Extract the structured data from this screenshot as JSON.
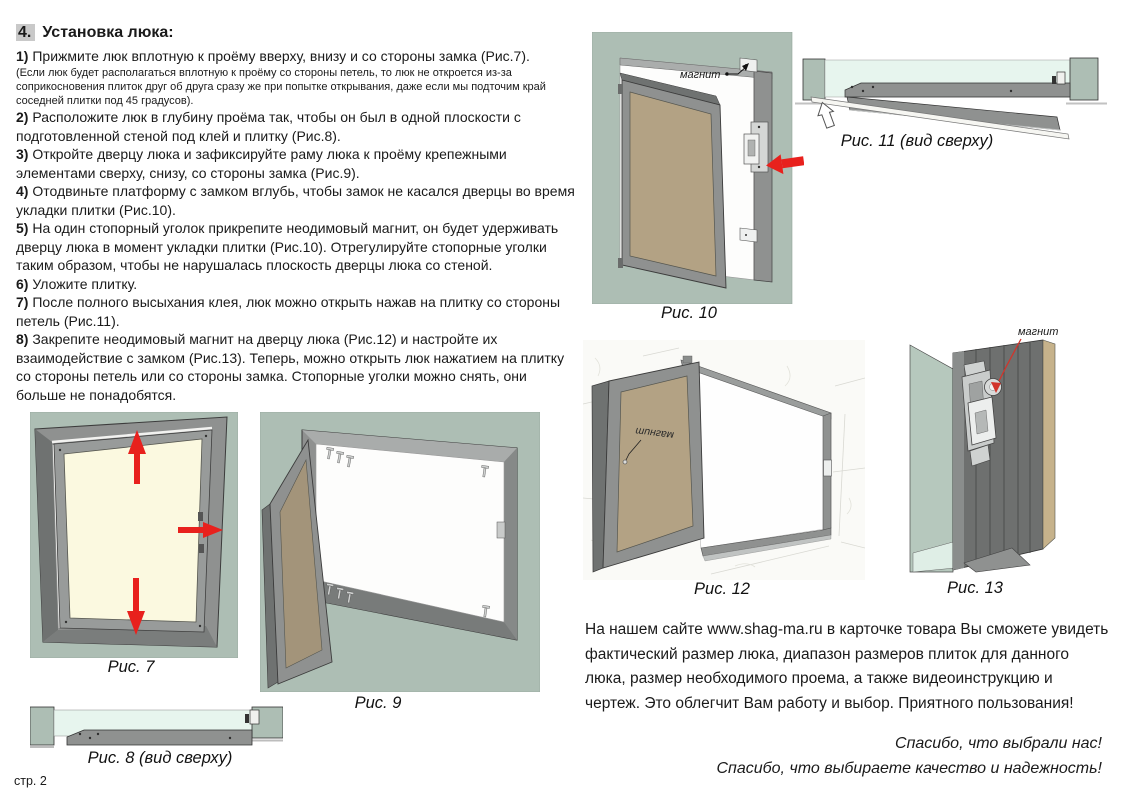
{
  "colors": {
    "accent_red": "#e8211d",
    "figure_background": "#adbeb4",
    "mint_background": "#e7f5ee",
    "door_tan": "#b3a284",
    "door_cream": "#fbf9e0",
    "frame_gray": "#8f9190"
  },
  "instructions": {
    "heading_number": "4.",
    "heading_text": "Установка люка:",
    "step1_note": "(Если люк будет располагаться вплотную к проёму со стороны петель, то люк не откроется из-за соприкосновения плиток друг об друга сразу же при попытке открывания, даже если мы подточим край соседней плитки под 45 градусов).",
    "steps": [
      {
        "num": "1)",
        "text": "Прижмите люк вплотную к проёму вверху, внизу и со стороны замка (Рис.7)."
      },
      {
        "num": "2)",
        "text": "Расположите люк в глубину проёма так, чтобы он был в одной плоскости с подготовленной стеной под клей и плитку (Рис.8)."
      },
      {
        "num": "3)",
        "text": "Откройте дверцу люка и зафиксируйте раму люка к проёму крепежными элементами сверху, снизу, со стороны замка (Рис.9)."
      },
      {
        "num": "4)",
        "text": "Отодвиньте платформу с замком вглубь, чтобы замок не касался дверцы во время укладки плитки (Рис.10)."
      },
      {
        "num": "5)",
        "text": "На один стопорный уголок прикрепите неодимовый магнит, он будет удерживать дверцу люка в момент укладки плитки (Рис.10). Отрегулируйте стопорные уголки таким образом, чтобы не нарушалась плоскость дверцы люка со стеной."
      },
      {
        "num": "6)",
        "text": "Уложите плитку."
      },
      {
        "num": "7)",
        "text": "После полного высыхания клея, люк можно открыть нажав на плитку со стороны петель (Рис.11)."
      },
      {
        "num": "8)",
        "text": "Закрепите неодимовый магнит на дверцу люка (Рис.12) и настройте их взаимодействие с замком (Рис.13). Теперь, можно открыть люк нажатием на плитку со стороны петель или со стороны замка. Стопорные уголки можно снять, они больше не понадобятся."
      }
    ]
  },
  "figures": {
    "fig7": {
      "caption": "Рис. 7"
    },
    "fig8": {
      "caption": "Рис. 8 (вид сверху)"
    },
    "fig9": {
      "caption": "Рис. 9"
    },
    "fig10": {
      "caption": "Рис. 10",
      "magnet_label": "магнит"
    },
    "fig11": {
      "caption": "Рис. 11 (вид сверху)"
    },
    "fig12": {
      "caption": "Рис. 12",
      "magnet_label": "магнит"
    },
    "fig13": {
      "caption": "Рис. 13",
      "magnet_label": "магнит"
    }
  },
  "footer": {
    "website_paragraph": "На нашем сайте www.shag-ma.ru в карточке товара Вы сможете увидеть фактический размер люка, диапазон размеров плиток для данного люка, размер необходимого проема, а также видеоинструкцию и чертеж. Это облегчит Вам работу и выбор. Приятного пользования!",
    "thanks_line1": "Спасибо, что выбрали нас!",
    "thanks_line2": "Спасибо, что выбираете качество и надежность!"
  },
  "document": {
    "page_label": "стр. 2"
  }
}
